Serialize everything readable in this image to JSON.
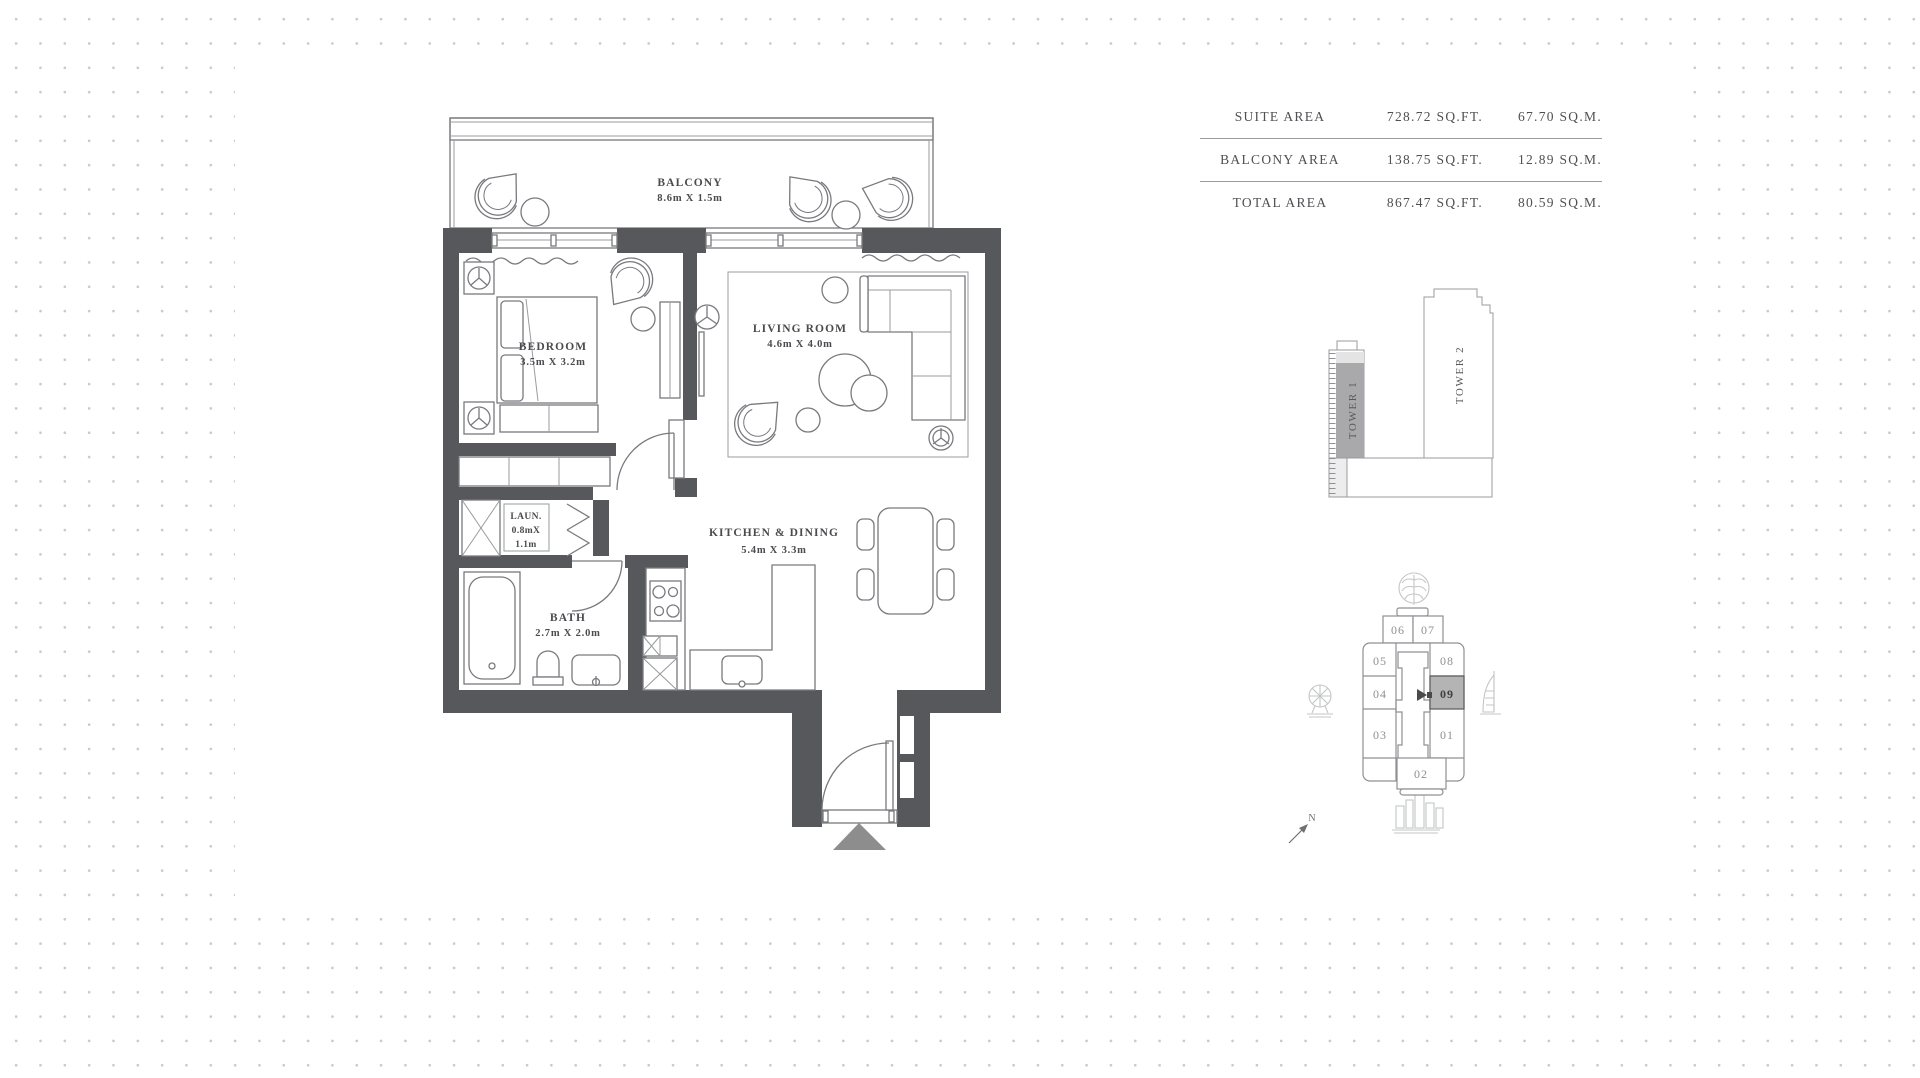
{
  "floor_plan": {
    "balcony": {
      "label": "BALCONY",
      "dims": "8.6m X 1.5m"
    },
    "bedroom": {
      "label": "BEDROOM",
      "dims": "3.5m X 3.2m"
    },
    "living_room": {
      "label": "LIVING ROOM",
      "dims": "4.6m X 4.0m"
    },
    "laundry": {
      "label": "LAUN.",
      "dims_line1": "0.8mX",
      "dims_line2": "1.1m"
    },
    "bath": {
      "label": "BATH",
      "dims": "2.7m X 2.0m"
    },
    "kitchen_dining": {
      "label": "KITCHEN & DINING",
      "dims": "5.4m X 3.3m"
    }
  },
  "area_table": {
    "rows": [
      {
        "label": "SUITE AREA",
        "sqft": "728.72 SQ.FT.",
        "sqm": "67.70 SQ.M."
      },
      {
        "label": "BALCONY AREA",
        "sqft": "138.75 SQ.FT.",
        "sqm": "12.89 SQ.M."
      },
      {
        "label": "TOTAL AREA",
        "sqft": "867.47 SQ.FT.",
        "sqm": "80.59 SQ.M."
      }
    ]
  },
  "tower_diagram": {
    "tower1_label": "TOWER 1",
    "tower2_label": "TOWER 2",
    "tower1_highlight_color": "#a9a9ab"
  },
  "key_plan": {
    "units": {
      "u01": "01",
      "u02": "02",
      "u03": "03",
      "u04": "04",
      "u05": "05",
      "u06": "06",
      "u07": "07",
      "u08": "08",
      "u09": "09"
    },
    "highlighted_unit": "09",
    "highlight_color": "#b4b4b4",
    "north_label": "N"
  },
  "colors": {
    "wall": "#57585b",
    "plan_line": "#797a7e",
    "dot": "#c9c9ca",
    "entry_marker": "#8d8d8d"
  }
}
